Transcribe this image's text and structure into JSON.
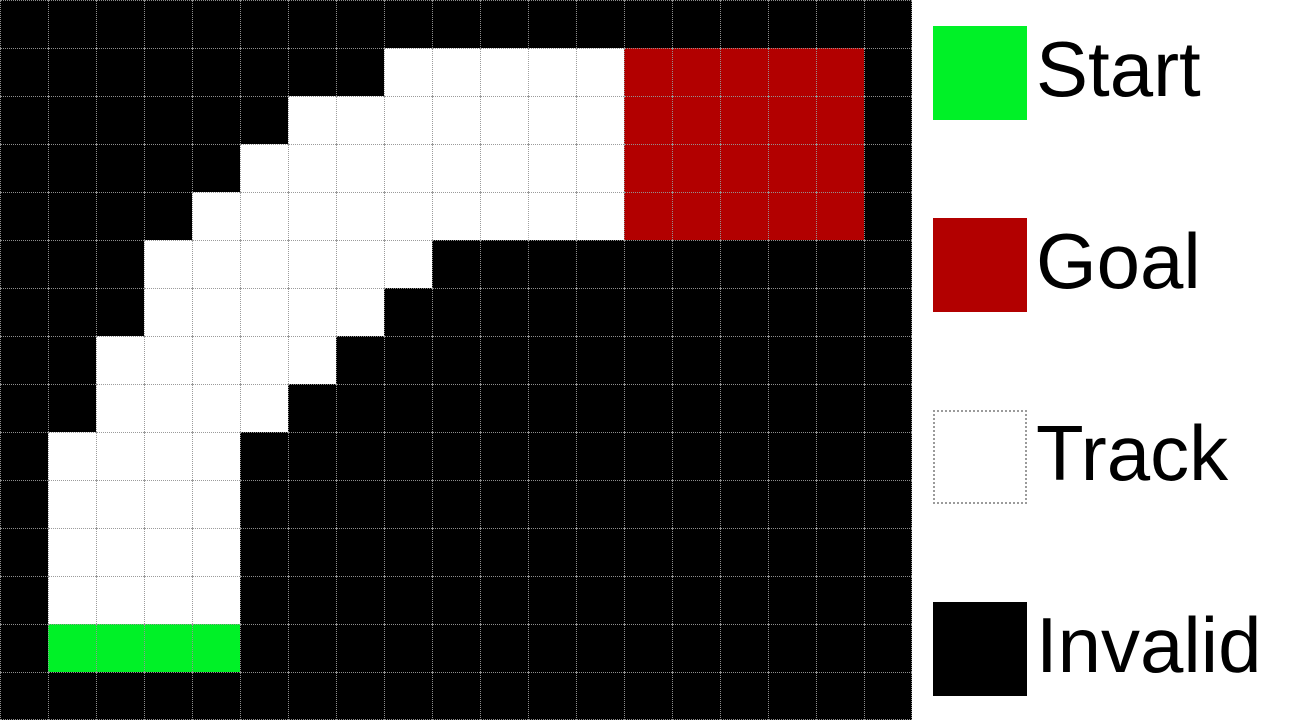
{
  "figure": {
    "grid": {
      "columns": 19,
      "rows": 15,
      "cell_size_px": 48,
      "cell_types": {
        "B": "invalid",
        "T": "track",
        "S": "start",
        "G": "goal"
      },
      "map": [
        "BBBBBBBBBBBBBBBBBBB",
        "BBBBBBBBTTTTTGGGGGB",
        "BBBBBBTTTTTTTGGGGGB",
        "BBBBBTTTTTTTTGGGGGB",
        "BBBBTTTTTTTTTGGGGGB",
        "BBBTTTTTTBBBBBBBBBB",
        "BBBTTTTTBBBBBBBBBBB",
        "BBTTTTTBBBBBBBBBBBB",
        "BBTTTTBBBBBBBBBBBBB",
        "BTTTTBBBBBBBBBBBBBB",
        "BTTTTBBBBBBBBBBBBBB",
        "BTTTTBBBBBBBBBBBBBB",
        "BTTTTBBBBBBBBBBBBBB",
        "BSSSSBBBBBBBBBBBBBB",
        "BBBBBBBBBBBBBBBBBBB"
      ]
    },
    "colors": {
      "start": "#00F127",
      "goal": "#B20000",
      "track": "#FFFFFF",
      "invalid": "#000000",
      "gridline": "#969696",
      "legend_background": "#FFFFFF",
      "label_text": "#000000"
    },
    "legend": {
      "items": [
        {
          "type": "start",
          "label": "Start"
        },
        {
          "type": "goal",
          "label": "Goal"
        },
        {
          "type": "track",
          "label": "Track"
        },
        {
          "type": "invalid",
          "label": "Invalid"
        }
      ]
    }
  }
}
